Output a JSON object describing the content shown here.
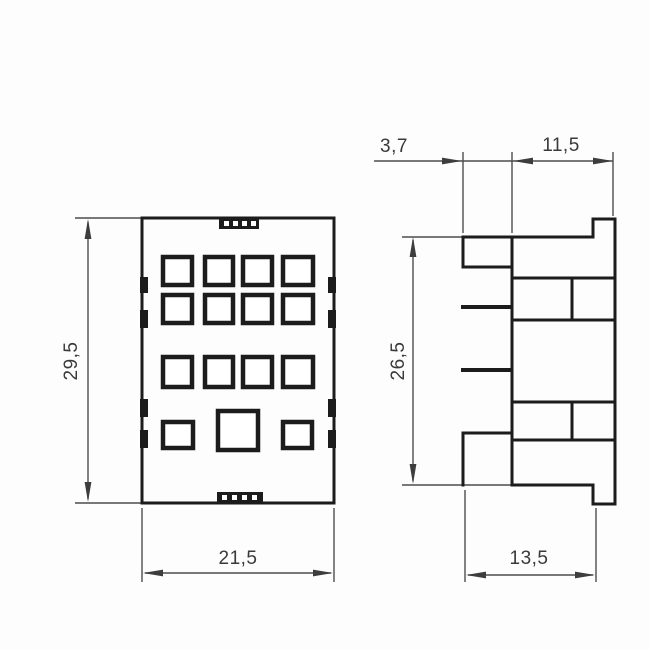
{
  "drawing": {
    "description": "Two-view technical dimension drawing of a relay socket",
    "background": "#fdfdfd",
    "line_color": "#1c1c1c",
    "dim_line_color": "#4d4d4d",
    "text_color": "#3a3a3a",
    "views": [
      {
        "id": "front-view",
        "description": "front face with terminal holes"
      },
      {
        "id": "side-view",
        "description": "side profile with terminal blocks"
      }
    ],
    "dims": {
      "front_height": "29,5",
      "front_width": "21,5",
      "side_plate_offset": "3,7",
      "side_top_width": "11,5",
      "side_height": "26,5",
      "side_bottom_width": "13,5"
    }
  }
}
